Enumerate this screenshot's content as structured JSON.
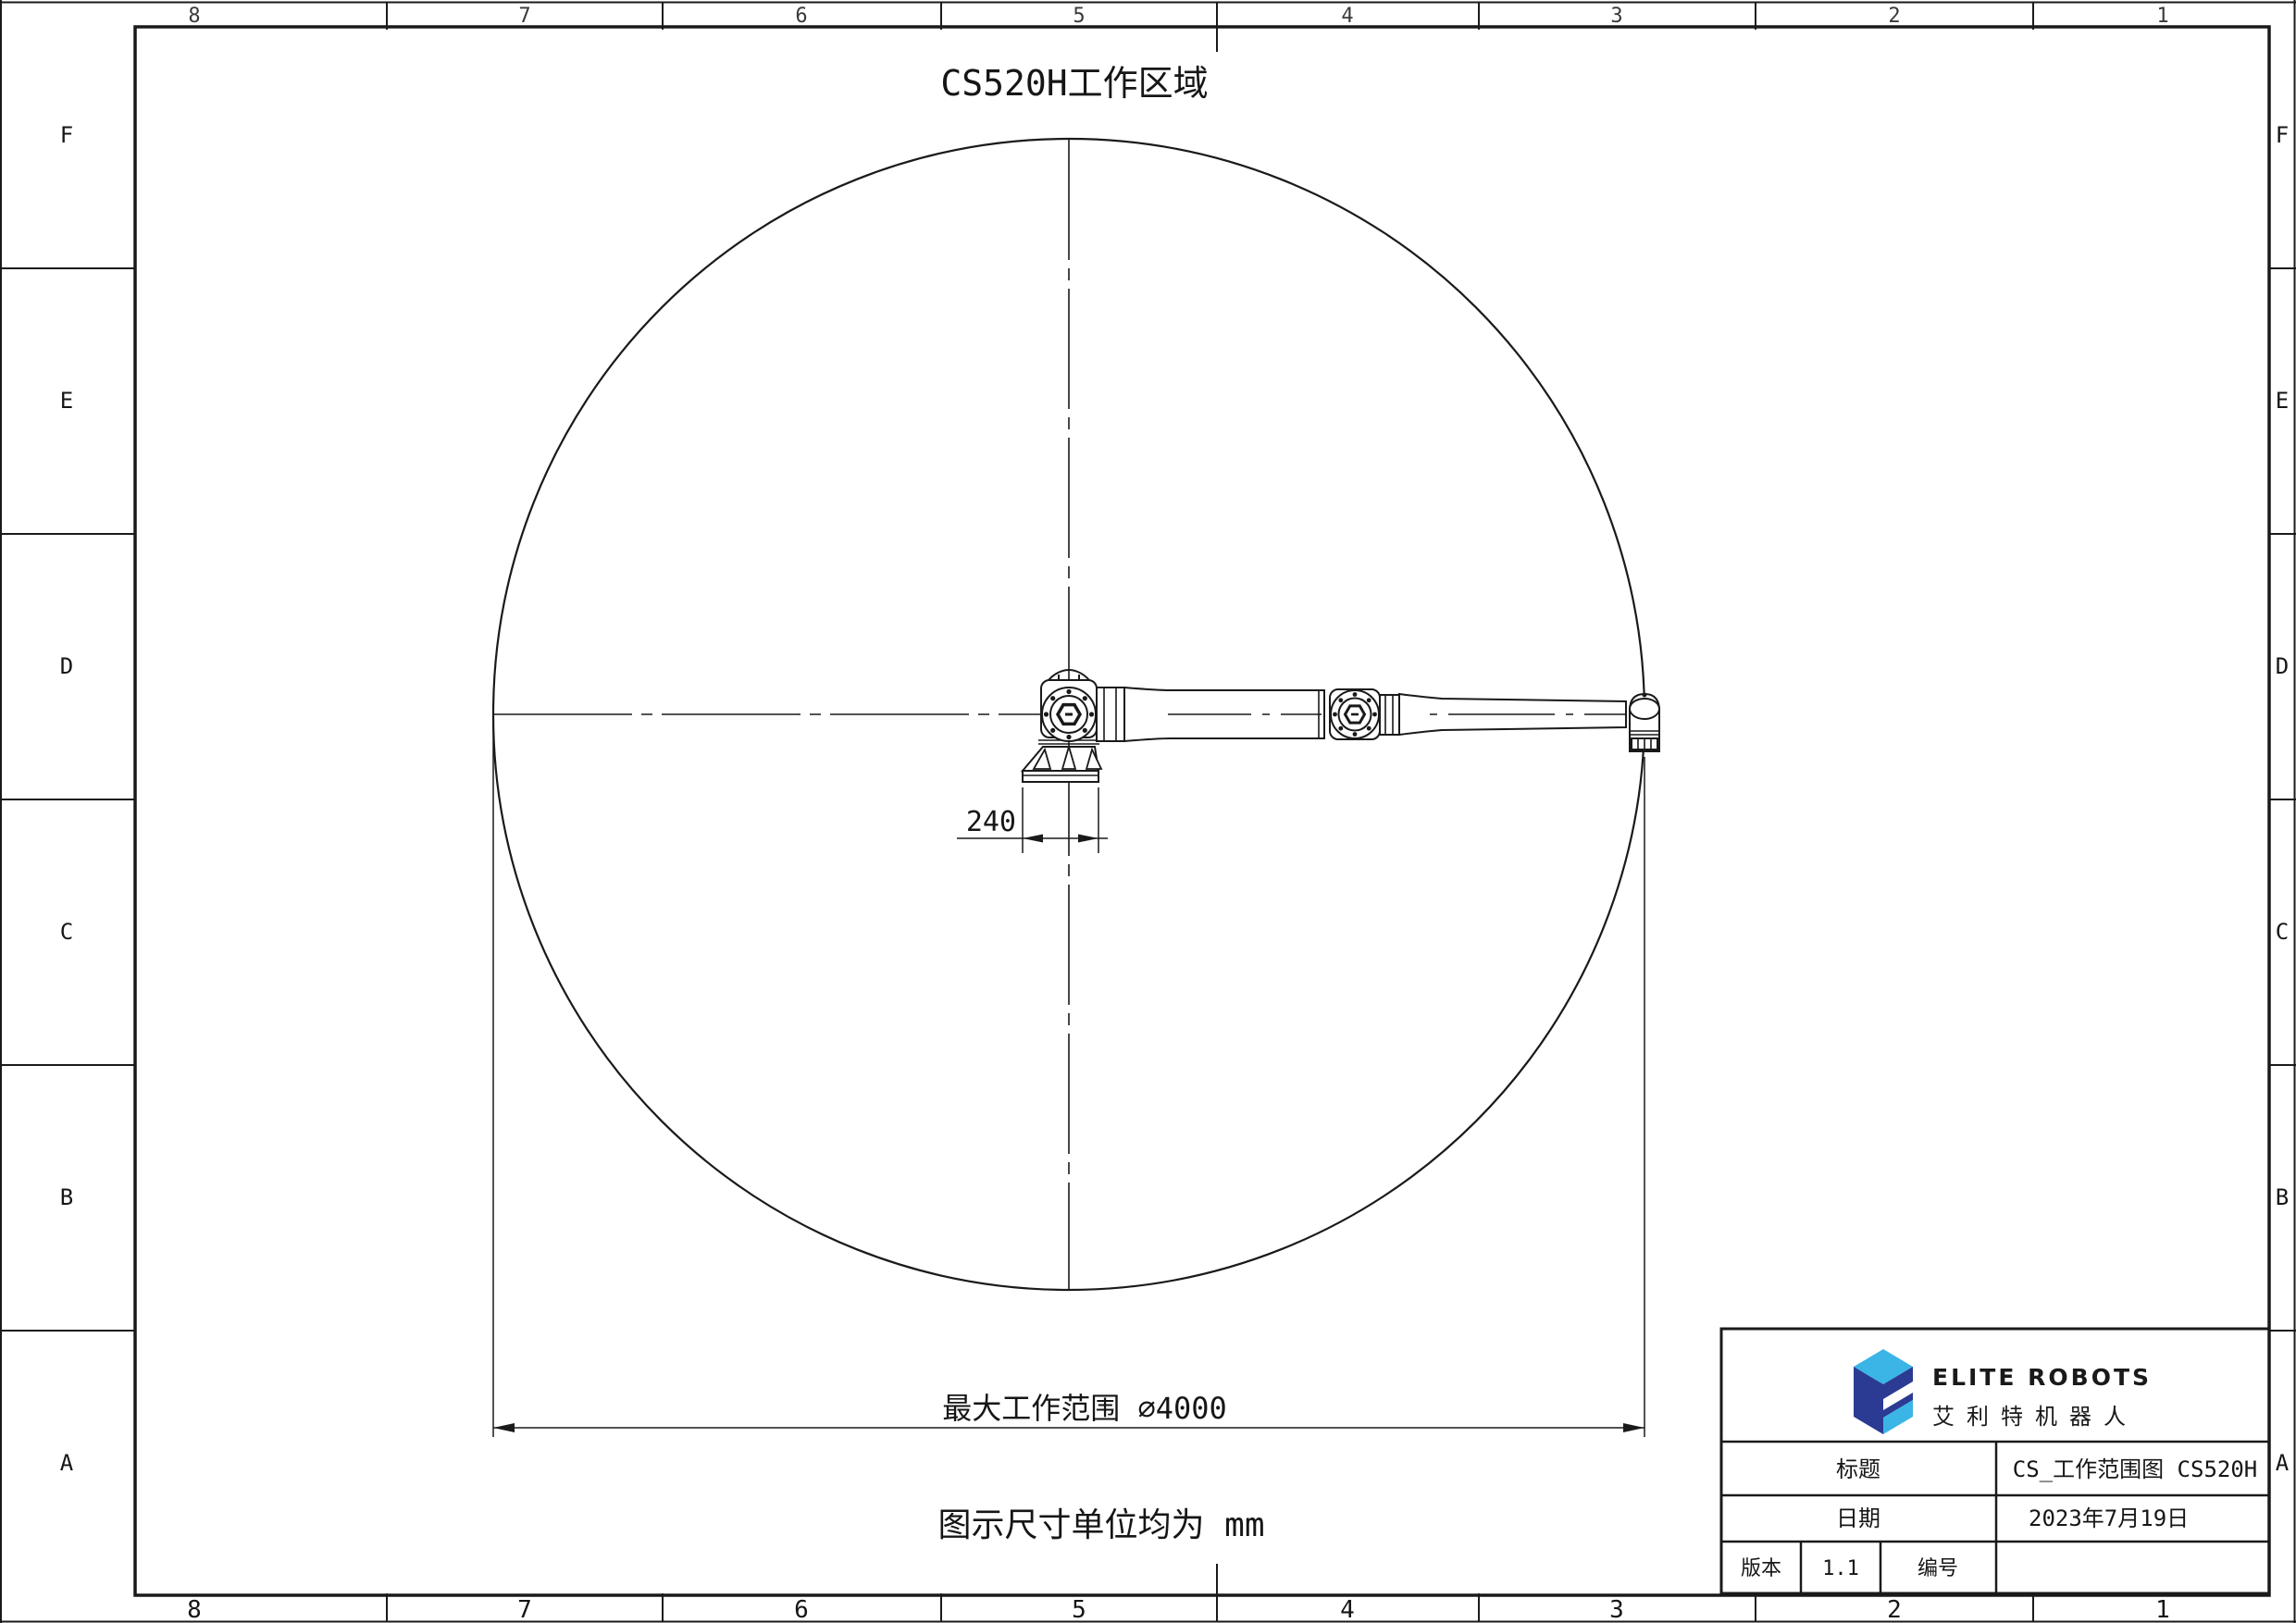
{
  "sheet": {
    "title": "CS520H工作区域",
    "unit_note": "图示尺寸单位均为 mm"
  },
  "dimensions": {
    "base_width": "240",
    "max_range": "最大工作范围 ∅4000"
  },
  "border": {
    "column_labels": [
      "8",
      "7",
      "6",
      "5",
      "4",
      "3",
      "2",
      "1"
    ],
    "row_labels": [
      "F",
      "E",
      "D",
      "C",
      "B",
      "A"
    ]
  },
  "title_block": {
    "brand_en": "ELITE ROBOTS",
    "brand_cn": "艾利特机器人",
    "title_label": "标题",
    "title_value": "CS_工作范围图 CS520H",
    "date_label": "日期",
    "date_value": "2023年7月19日",
    "version_label": "版本",
    "version_value": "1.1",
    "number_label": "编号",
    "number_value": ""
  },
  "colors": {
    "line": "#1a1a1a",
    "logo_light": "#3ab5e6",
    "logo_dark": "#2b3a92"
  }
}
